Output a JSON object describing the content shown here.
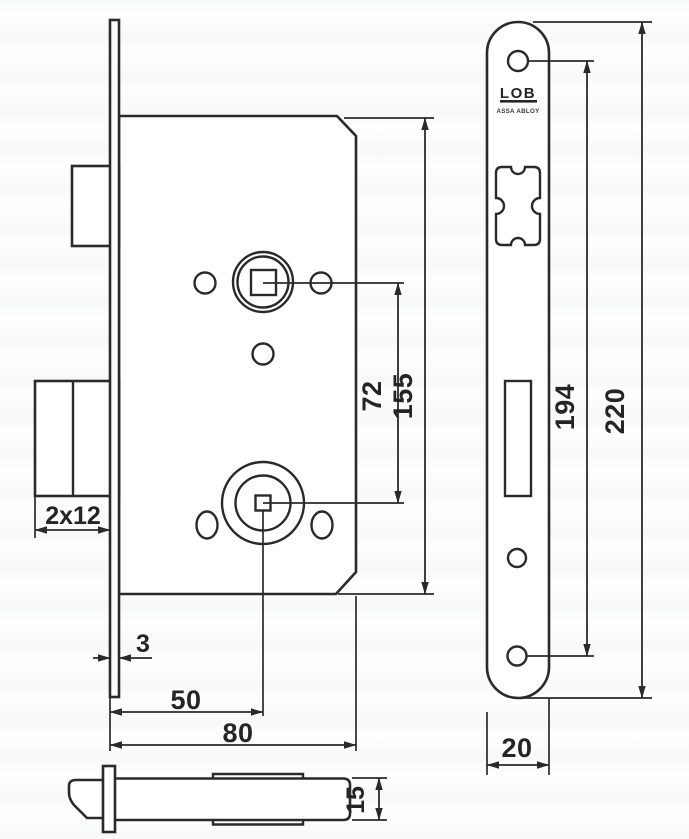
{
  "drawing": {
    "line_color": "#2b2a29",
    "background": "#fefefe"
  },
  "brand": {
    "logo_text": "LOB",
    "logo_subtitle": "ASSA ABLOY"
  },
  "dimensions": {
    "deadbolt_throw": "2x12",
    "faceplate_thickness": "3",
    "backset": "50",
    "body_depth": "80",
    "follower_to_key_spacing": "72",
    "body_height": "155",
    "screw_hole_spacing": "194",
    "faceplate_height": "220",
    "faceplate_width": "20",
    "latch_height": "15"
  }
}
